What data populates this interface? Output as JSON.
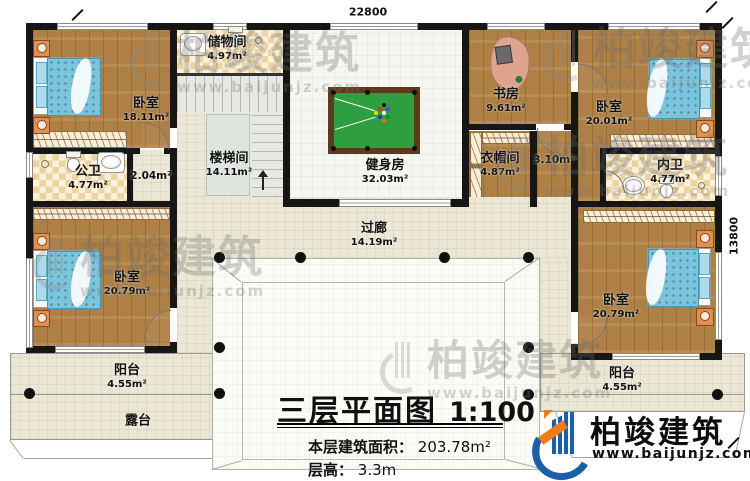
{
  "plan": {
    "dimensions": {
      "width_mm": "22800",
      "height_mm": "13800"
    },
    "rooms": {
      "bedroom_top_left": {
        "name": "卧室",
        "area": "18.11m²"
      },
      "public_bathroom": {
        "name": "公卫",
        "area": "4.77m²"
      },
      "hallway_small_left": {
        "area": "2.04m²"
      },
      "storage_room": {
        "name": "储物间",
        "area": "4.97m²"
      },
      "stairwell": {
        "name": "楼梯间",
        "area": "14.11m²"
      },
      "gym": {
        "name": "健身房",
        "area": "32.03m²"
      },
      "study": {
        "name": "书房",
        "area": "9.61m²"
      },
      "bedroom_top_right": {
        "name": "卧室",
        "area": "20.01m²"
      },
      "cloakroom": {
        "name": "衣帽间",
        "area": "4.87m²"
      },
      "hallway_small_right": {
        "area": "3.10m²"
      },
      "ensuite_bathroom": {
        "name": "内卫",
        "area": "4.77m²"
      },
      "corridor": {
        "name": "过廊",
        "area": "14.19m²"
      },
      "bedroom_bottom_left": {
        "name": "卧室",
        "area": "20.79m²"
      },
      "bedroom_bottom_right": {
        "name": "卧室",
        "area": "20.79m²"
      },
      "balcony_left": {
        "name": "阳台",
        "area": "4.55m²"
      },
      "balcony_right": {
        "name": "阳台",
        "area": "4.55m²"
      },
      "terrace": {
        "name": "露台"
      }
    }
  },
  "title_block": {
    "title": "三层平面图",
    "scale": "1:100",
    "area_label": "本层建筑面积：",
    "area_value": "203.78m²",
    "floor_height_label": "层高：",
    "floor_height_value": "3.3m"
  },
  "branding": {
    "brand": "柏竣建筑",
    "website": "www.baijunjz.com"
  },
  "icons": {
    "bed": "bed-icon",
    "toilet": "toilet-icon",
    "sink": "sink-icon",
    "billiard_table": "billiard-table-icon",
    "desk": "desk-icon",
    "column": "column-dot",
    "stairs_arrow": "stair-direction-arrow"
  },
  "colors": {
    "wall": "#161616",
    "wood_floor": "#ae8045",
    "tile_floor": "#ecd3a0",
    "cream_floor": "#ebe7d5",
    "pool_table_green": "#2f9e3f",
    "bed_blue": "#7cc4dc",
    "logo_blue": "#1b5fa8",
    "logo_orange": "#ee7d18"
  }
}
